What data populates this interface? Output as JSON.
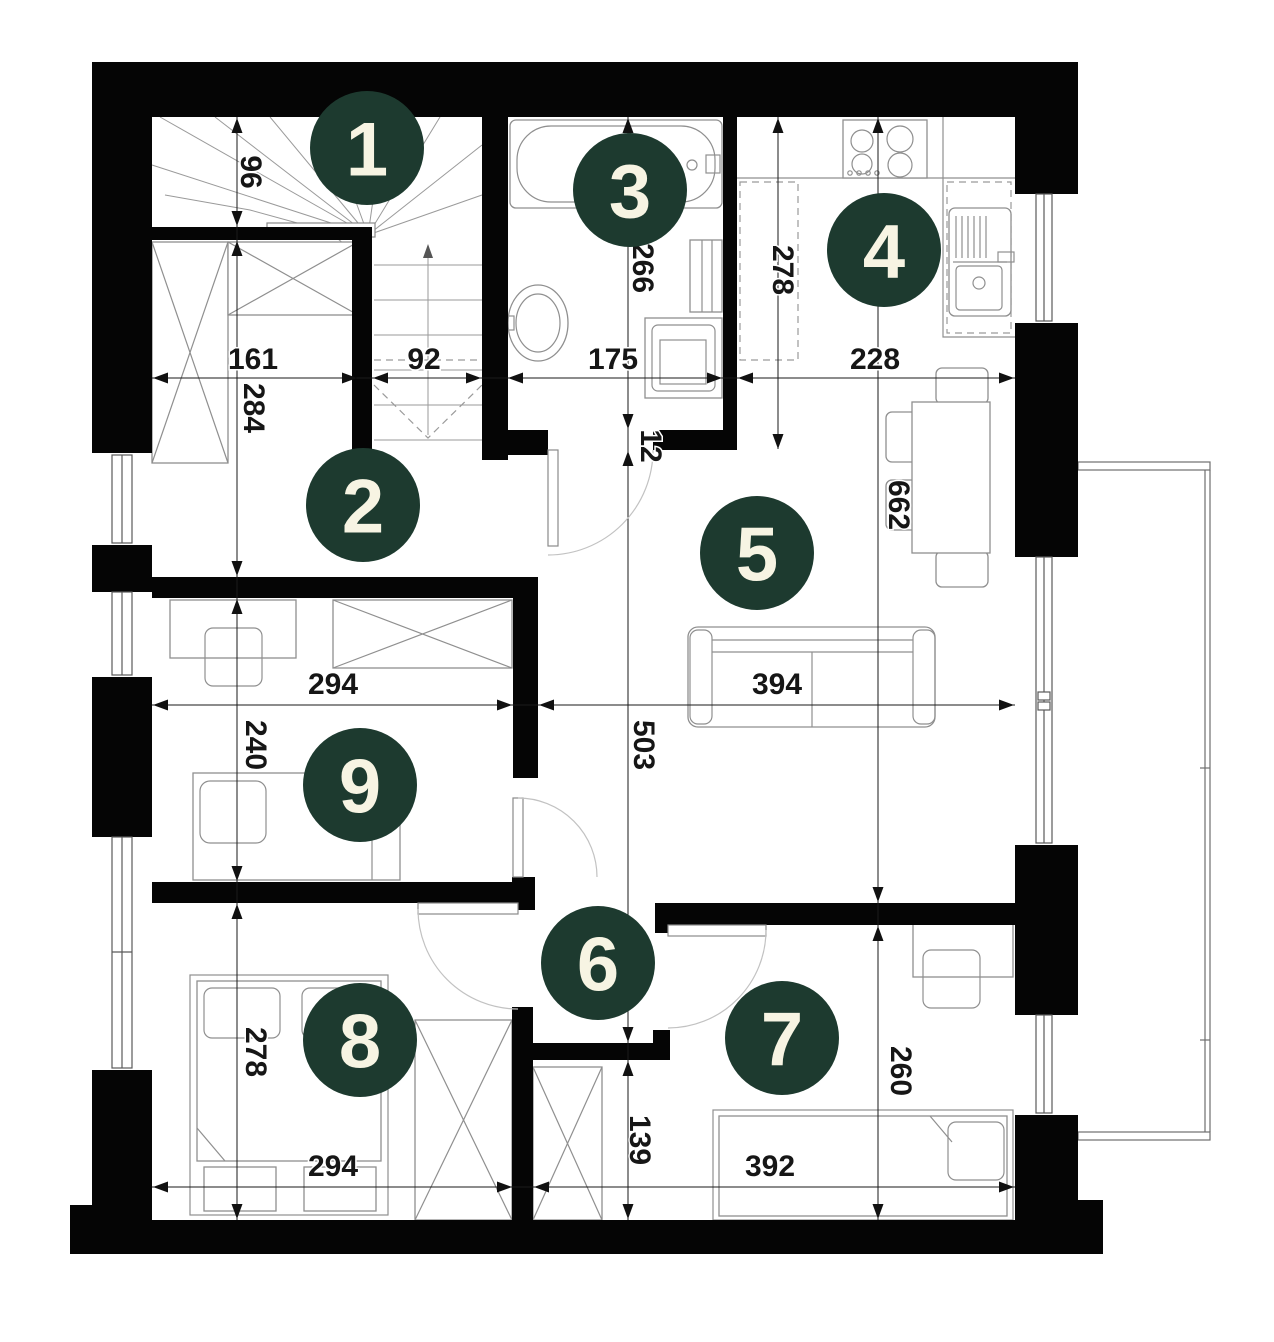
{
  "colors": {
    "marker_fill": "#1d3a2f",
    "marker_text": "#f7f4e3",
    "wall": "#050505",
    "furniture_line": "#8f8f8f",
    "dimension_line": "#1a1a1a"
  },
  "room_markers": [
    {
      "number": "1",
      "x": 367,
      "y": 148
    },
    {
      "number": "2",
      "x": 363,
      "y": 505
    },
    {
      "number": "3",
      "x": 630,
      "y": 190
    },
    {
      "number": "4",
      "x": 884,
      "y": 250
    },
    {
      "number": "5",
      "x": 757,
      "y": 553
    },
    {
      "number": "6",
      "x": 598,
      "y": 963
    },
    {
      "number": "7",
      "x": 782,
      "y": 1038
    },
    {
      "number": "8",
      "x": 360,
      "y": 1040
    },
    {
      "number": "9",
      "x": 360,
      "y": 785
    }
  ],
  "dimension_labels": [
    {
      "text": "96",
      "x": 241,
      "y": 172,
      "rotated": true
    },
    {
      "text": "161",
      "x": 253,
      "y": 369,
      "rotated": false
    },
    {
      "text": "92",
      "x": 424,
      "y": 369,
      "rotated": false
    },
    {
      "text": "284",
      "x": 244,
      "y": 408,
      "rotated": true
    },
    {
      "text": "266",
      "x": 633,
      "y": 268,
      "rotated": true
    },
    {
      "text": "175",
      "x": 613,
      "y": 369,
      "rotated": false
    },
    {
      "text": "12",
      "x": 641,
      "y": 446,
      "rotated": true
    },
    {
      "text": "278",
      "x": 773,
      "y": 270,
      "rotated": true
    },
    {
      "text": "228",
      "x": 875,
      "y": 369,
      "rotated": false
    },
    {
      "text": "662",
      "x": 889,
      "y": 505,
      "rotated": true
    },
    {
      "text": "294",
      "x": 333,
      "y": 694,
      "rotated": false
    },
    {
      "text": "394",
      "x": 777,
      "y": 694,
      "rotated": false
    },
    {
      "text": "240",
      "x": 246,
      "y": 745,
      "rotated": true
    },
    {
      "text": "503",
      "x": 634,
      "y": 745,
      "rotated": true
    },
    {
      "text": "278",
      "x": 246,
      "y": 1052,
      "rotated": true
    },
    {
      "text": "260",
      "x": 891,
      "y": 1071,
      "rotated": true
    },
    {
      "text": "294",
      "x": 333,
      "y": 1176,
      "rotated": false
    },
    {
      "text": "139",
      "x": 630,
      "y": 1140,
      "rotated": true
    },
    {
      "text": "392",
      "x": 770,
      "y": 1176,
      "rotated": false
    }
  ]
}
